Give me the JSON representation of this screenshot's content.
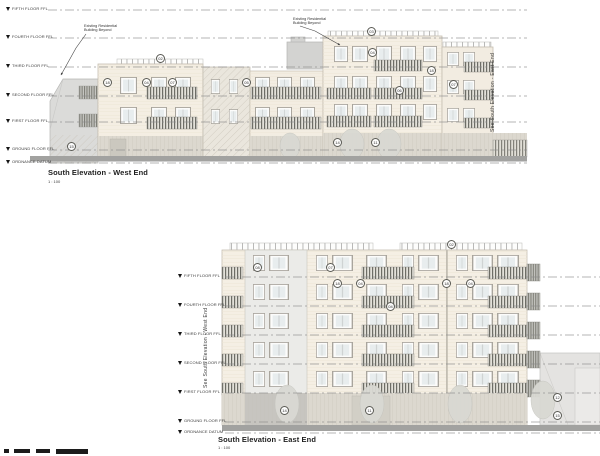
{
  "west_elevation": {
    "title": "South Elevation - West End",
    "scale": "1 : 100",
    "match_line": "See South Elevation - East End",
    "levels": [
      "FIFTH FLOOR FFL",
      "FOURTH FLOOR FFL",
      "THIRD FLOOR FFL",
      "SECOND FLOOR FFL",
      "FIRST FLOOR FFL",
      "GROUND FLOOR FFL",
      "ORDNANCE DATUM"
    ],
    "keynotes": [
      "02",
      "18",
      "04",
      "07",
      "05",
      "03",
      "04",
      "06",
      "18",
      "07",
      "15",
      "14",
      "11"
    ]
  },
  "east_elevation": {
    "title": "South Elevation - East End",
    "scale": "1 : 100",
    "match_line": "See South Elevation - West End",
    "levels": [
      "FIFTH FLOOR FFL",
      "FOURTH FLOOR FFL",
      "THIRD FLOOR FFL",
      "SECOND FLOOR FFL",
      "FIRST FLOOR FFL",
      "GROUND FLOOR FFL",
      "ORDNANCE DATUM"
    ],
    "keynotes": [
      "02",
      "08",
      "07",
      "18",
      "04",
      "18",
      "04",
      "04",
      "14",
      "11",
      "12",
      "15"
    ]
  },
  "notes": {
    "existing_building_line1": "Existing Residential",
    "existing_building_line2": "Building Beyond"
  },
  "colors": {
    "facade_cream": "#f4eee3",
    "massing_gray": "#dbdbd9",
    "ground_bar": "#a2a2a0",
    "railing_dark": "#6d6d66",
    "level_line": "#8a8a8a"
  }
}
